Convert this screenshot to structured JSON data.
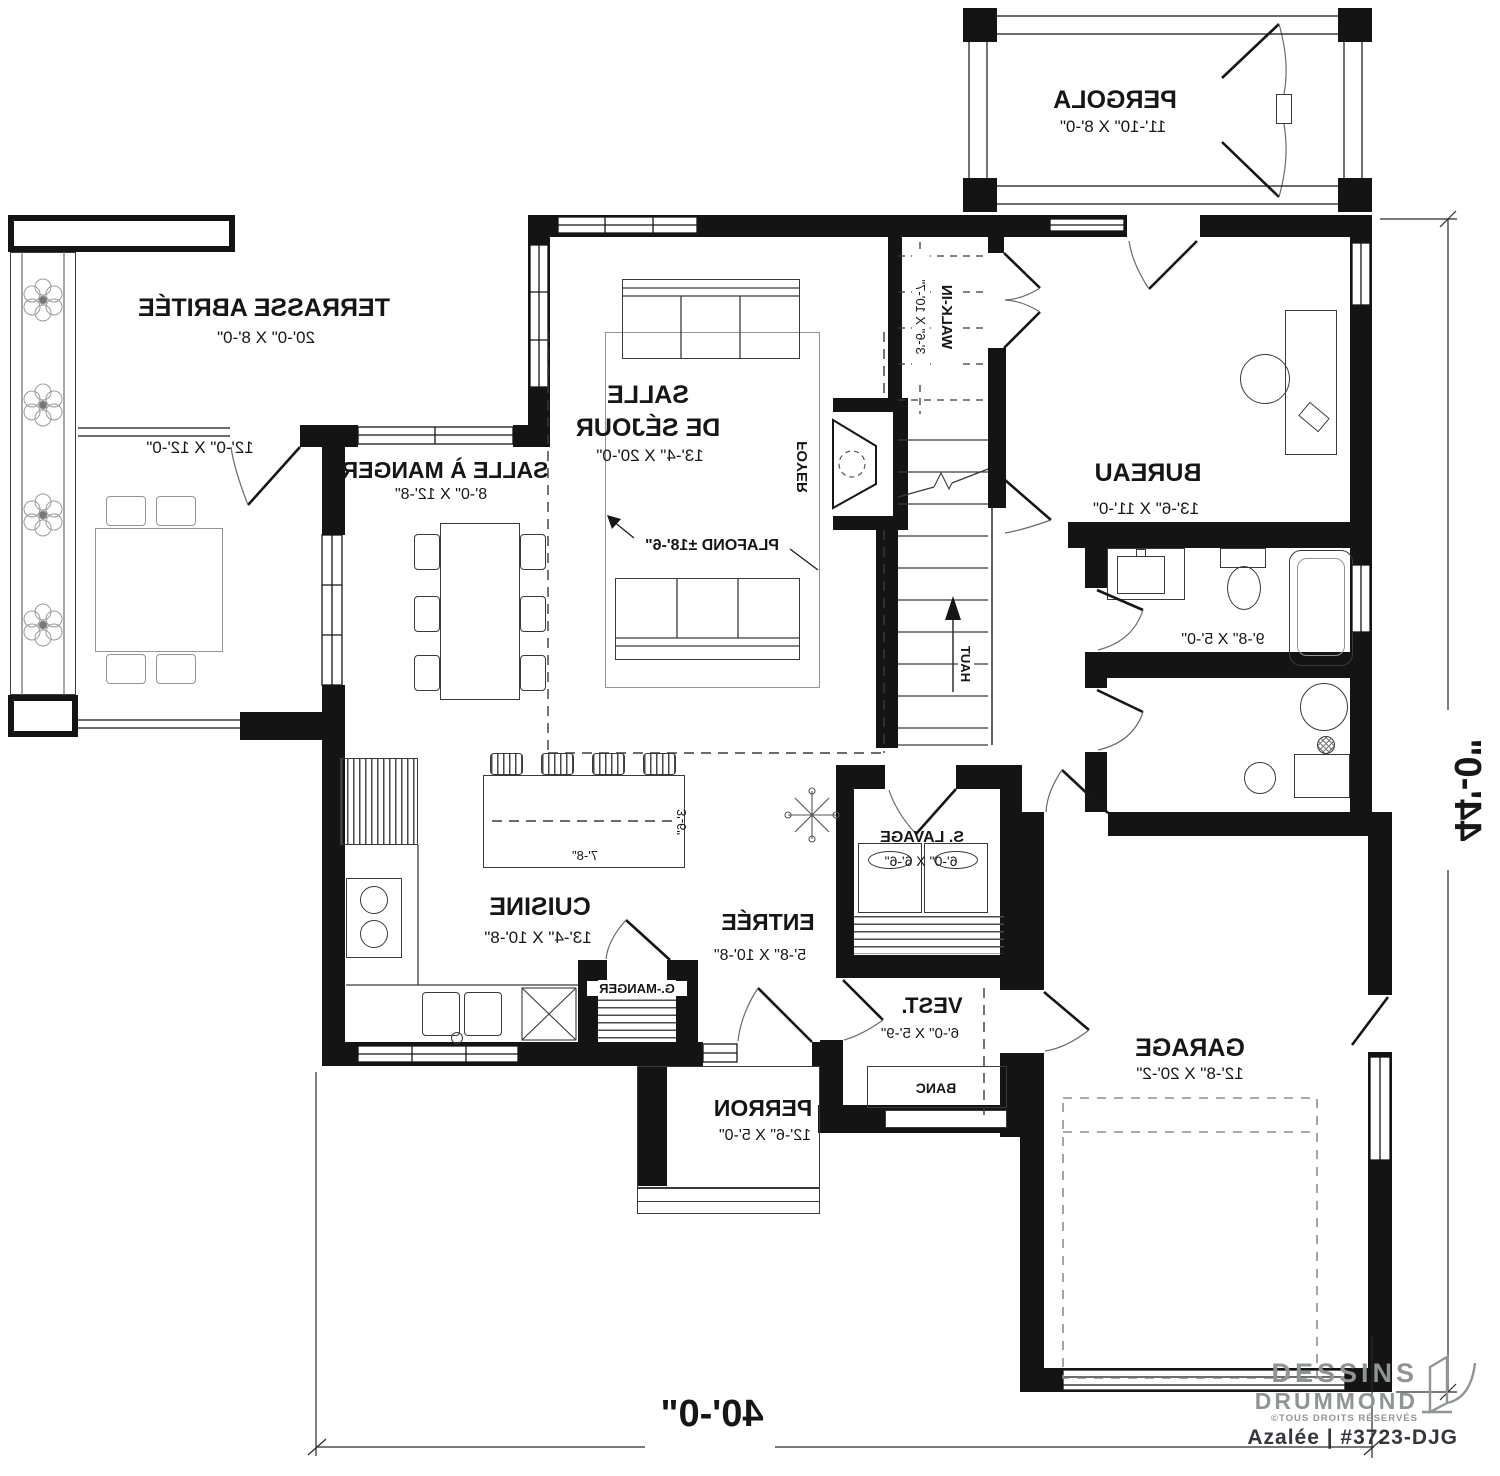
{
  "colors": {
    "wall": "#141414",
    "line": "#3a3a3a",
    "light_gray": "#8f9494"
  },
  "rooms": {
    "pergola": {
      "name": "PERGOLA",
      "dim": "11'-10\" X 8'-0\""
    },
    "terrasse": {
      "name": "TERRASSE ABRITÉE",
      "dim": "20'-0\" X 8'-0\"",
      "dim2": "12'-0\" X 12'-0\""
    },
    "sejour": {
      "name_line1": "SALLE",
      "name_line2": "DE SÉJOUR",
      "dim": "13'-4\" X 20'-0\"",
      "ceiling": "PLAFOND ±18'-6\""
    },
    "manger": {
      "name": "SALLE À MANGER",
      "dim": "8'-0\" X 12'-8\""
    },
    "bureau": {
      "name": "BUREAU",
      "dim": "13'-6\" X 11'-0\""
    },
    "walkin": {
      "name": "WALK-IN",
      "dim": "3'-6\" X 10'-7\""
    },
    "foyer": {
      "name": "FOYER"
    },
    "bain": {
      "dim": "9'-8\" X 5'-0\""
    },
    "cuisine": {
      "name": "CUISINE",
      "dim": "13'-4\" X 10'-8\"",
      "island_w": "7'-8\"",
      "island_d": "3'-6\"",
      "pantry": "G.-MANGER"
    },
    "entree": {
      "name": "ENTRÉE",
      "dim": "5'-8\" X 10'-8\""
    },
    "slavage": {
      "name": "S. LAVAGE",
      "dim": "6'-0\" X 6'-6\""
    },
    "vest": {
      "name": "VEST.",
      "dim": "6'-0\" X 5'-9\"",
      "bench": "BANC"
    },
    "perron": {
      "name": "PERRON",
      "dim": "12'-6\" X 5'-0\""
    },
    "garage": {
      "name": "GARAGE",
      "dim": "12'-8\" X 20'-2\""
    },
    "stairs": {
      "up": "HAUT"
    }
  },
  "dimensions": {
    "overall_width": "40'-0\"",
    "overall_depth": "44'-0\""
  },
  "logo": {
    "brand_line1": "DESSINS",
    "brand_line2": "DRUMMOND",
    "rights": "©TOUS DROITS RÉSERVÉS",
    "model": "Azalée | #3723-DJG"
  }
}
